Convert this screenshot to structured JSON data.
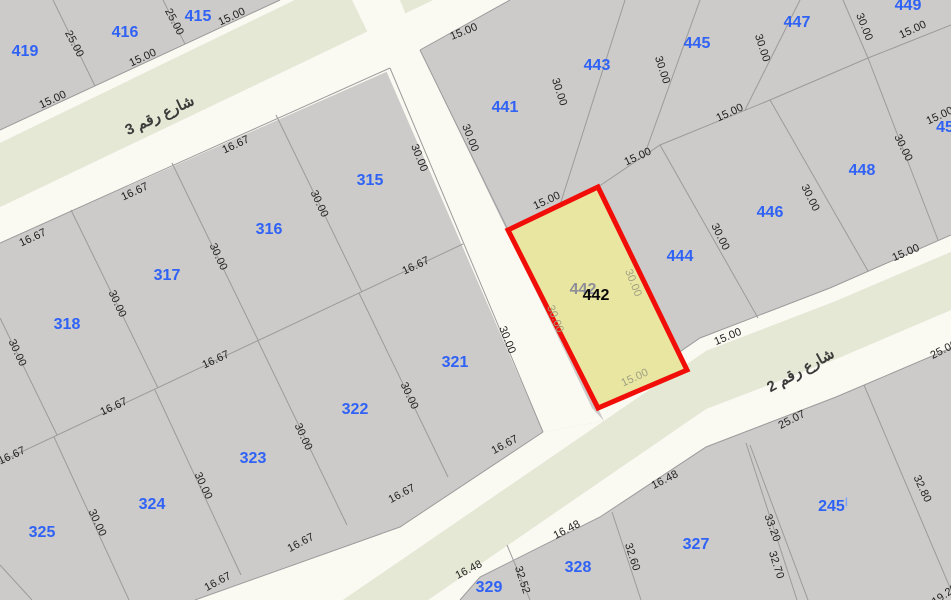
{
  "map": {
    "name": "cadastral-parcel-map",
    "colors": {
      "parcel_fill": "#cccbca",
      "boundary_line": "#9b9b9b",
      "street_white": "#fbfaf2",
      "street_green": "#e5e8d4",
      "highlight_fill": "#e9e6a2",
      "highlight_stroke": "#f10e08",
      "parcel_label": "#2f62f5",
      "parcel_label_light": "#7da2f8",
      "dim_label": "#222222",
      "highlight_dim": "#a0a082",
      "ghost_label": "#8e8e96",
      "street_label": "#3b3b3b",
      "highlight_label": "#0a0a0a"
    },
    "streets": [
      {
        "name": "شارع رقم 3",
        "x": 160,
        "y": 116,
        "rot": -25
      },
      {
        "name": "شارع رقم 2",
        "x": 801,
        "y": 371,
        "rot": -29
      }
    ],
    "parcels": [
      {
        "label": "419",
        "x": 25,
        "y": 52
      },
      {
        "label": "416",
        "x": 125,
        "y": 33
      },
      {
        "label": "415",
        "x": 198,
        "y": 17
      },
      {
        "label": "441",
        "x": 505,
        "y": 108
      },
      {
        "label": "443",
        "x": 597,
        "y": 66
      },
      {
        "label": "445",
        "x": 697,
        "y": 44
      },
      {
        "label": "447",
        "x": 797,
        "y": 23
      },
      {
        "label": "449",
        "x": 908,
        "y": 6
      },
      {
        "label": "446",
        "x": 770,
        "y": 213
      },
      {
        "label": "444",
        "x": 680,
        "y": 257
      },
      {
        "label": "448",
        "x": 862,
        "y": 171
      },
      {
        "label": "45",
        "x": 945,
        "y": 128
      },
      {
        "label": "315",
        "x": 370,
        "y": 181
      },
      {
        "label": "316",
        "x": 269,
        "y": 230
      },
      {
        "label": "317",
        "x": 167,
        "y": 276
      },
      {
        "label": "318",
        "x": 67,
        "y": 325
      },
      {
        "label": "321",
        "x": 455,
        "y": 363
      },
      {
        "label": "322",
        "x": 355,
        "y": 410
      },
      {
        "label": "323",
        "x": 253,
        "y": 459
      },
      {
        "label": "324",
        "x": 152,
        "y": 505
      },
      {
        "label": "325",
        "x": 42,
        "y": 533
      },
      {
        "label": "329",
        "x": 489,
        "y": 588
      },
      {
        "label": "328",
        "x": 578,
        "y": 568
      },
      {
        "label": "327",
        "x": 696,
        "y": 545
      },
      {
        "label": "245",
        "x": 833,
        "y": 507,
        "suffix": "ا"
      }
    ],
    "highlight": {
      "label": "442",
      "x": 596,
      "y": 296,
      "ghost_label": "442",
      "ghost_x": 583,
      "ghost_y": 290
    },
    "dimensions": [
      {
        "t": "25.00",
        "x": 74,
        "y": 44,
        "r": 62
      },
      {
        "t": "25.00",
        "x": 174,
        "y": 22,
        "r": 62
      },
      {
        "t": "15.00",
        "x": 53,
        "y": 100,
        "r": -25
      },
      {
        "t": "15.00",
        "x": 143,
        "y": 58,
        "r": -25
      },
      {
        "t": "15.00",
        "x": 232,
        "y": 17,
        "r": -25
      },
      {
        "t": "16.67",
        "x": 33,
        "y": 238,
        "r": -25
      },
      {
        "t": "16.67",
        "x": 135,
        "y": 192,
        "r": -25
      },
      {
        "t": "16.67",
        "x": 236,
        "y": 145,
        "r": -25
      },
      {
        "t": "16.67",
        "x": 416,
        "y": 266,
        "r": -25
      },
      {
        "t": "16.67",
        "x": 216,
        "y": 360,
        "r": -25
      },
      {
        "t": "16.67",
        "x": 114,
        "y": 407,
        "r": -25
      },
      {
        "t": "16.67",
        "x": 12,
        "y": 456,
        "r": -25
      },
      {
        "t": "30.00",
        "x": 319,
        "y": 204,
        "r": 65
      },
      {
        "t": "30.00",
        "x": 218,
        "y": 257,
        "r": 65
      },
      {
        "t": "30.00",
        "x": 117,
        "y": 304,
        "r": 65
      },
      {
        "t": "30.00",
        "x": 17,
        "y": 353,
        "r": 65
      },
      {
        "t": "30.00",
        "x": 419,
        "y": 158,
        "r": 68
      },
      {
        "t": "30.00",
        "x": 507,
        "y": 340,
        "r": 68
      },
      {
        "t": "30.00",
        "x": 409,
        "y": 396,
        "r": 65
      },
      {
        "t": "30.00",
        "x": 303,
        "y": 437,
        "r": 65
      },
      {
        "t": "30.00",
        "x": 203,
        "y": 486,
        "r": 65
      },
      {
        "t": "30.00",
        "x": 97,
        "y": 523,
        "r": 65
      },
      {
        "t": "16.67",
        "x": 505,
        "y": 445,
        "r": -28
      },
      {
        "t": "16.67",
        "x": 402,
        "y": 494,
        "r": -28
      },
      {
        "t": "16.67",
        "x": 301,
        "y": 543,
        "r": -28
      },
      {
        "t": "16.67",
        "x": 218,
        "y": 582,
        "r": -28
      },
      {
        "t": "15.00",
        "x": 464,
        "y": 32,
        "r": -22
      },
      {
        "t": "30.00",
        "x": 470,
        "y": 138,
        "r": 68
      },
      {
        "t": "30.00",
        "x": 559,
        "y": 92,
        "r": 72
      },
      {
        "t": "30.00",
        "x": 662,
        "y": 70,
        "r": 72
      },
      {
        "t": "30.00",
        "x": 762,
        "y": 48,
        "r": 72
      },
      {
        "t": "30.00",
        "x": 864,
        "y": 27,
        "r": 68
      },
      {
        "t": "15.00",
        "x": 913,
        "y": 30,
        "r": -25
      },
      {
        "t": "15.00",
        "x": 547,
        "y": 201,
        "r": -25
      },
      {
        "t": "15.00",
        "x": 638,
        "y": 157,
        "r": -25
      },
      {
        "t": "15.00",
        "x": 730,
        "y": 113,
        "r": -25
      },
      {
        "t": "15.00",
        "x": 940,
        "y": 116,
        "r": -25
      },
      {
        "t": "30.00",
        "x": 720,
        "y": 237,
        "r": 64
      },
      {
        "t": "30.00",
        "x": 810,
        "y": 198,
        "r": 64
      },
      {
        "t": "30.00",
        "x": 903,
        "y": 148,
        "r": 64
      },
      {
        "t": "15.00",
        "x": 728,
        "y": 337,
        "r": -23
      },
      {
        "t": "15.00",
        "x": 906,
        "y": 253,
        "r": -23
      },
      {
        "t": "25.07",
        "x": 792,
        "y": 420,
        "r": -27
      },
      {
        "t": "25.00",
        "x": 944,
        "y": 350,
        "r": -27
      },
      {
        "t": "16.48",
        "x": 665,
        "y": 480,
        "r": -27
      },
      {
        "t": "16.48",
        "x": 567,
        "y": 530,
        "r": -27
      },
      {
        "t": "16.48",
        "x": 469,
        "y": 570,
        "r": -27
      },
      {
        "t": "32.52",
        "x": 522,
        "y": 580,
        "r": 72
      },
      {
        "t": "32.60",
        "x": 632,
        "y": 557,
        "r": 72
      },
      {
        "t": "33.20",
        "x": 772,
        "y": 528,
        "r": 70
      },
      {
        "t": "32.70",
        "x": 776,
        "y": 565,
        "r": 72
      },
      {
        "t": "32.80",
        "x": 922,
        "y": 489,
        "r": 65
      },
      {
        "t": "19.20",
        "x": 945,
        "y": 595,
        "r": -35
      },
      {
        "t": "30.00",
        "x": 555,
        "y": 319,
        "r": 68,
        "hl": true
      },
      {
        "t": "30.00",
        "x": 633,
        "y": 283,
        "r": 68,
        "hl": true
      },
      {
        "t": "15.00",
        "x": 635,
        "y": 378,
        "r": -25,
        "hl": true
      }
    ]
  }
}
